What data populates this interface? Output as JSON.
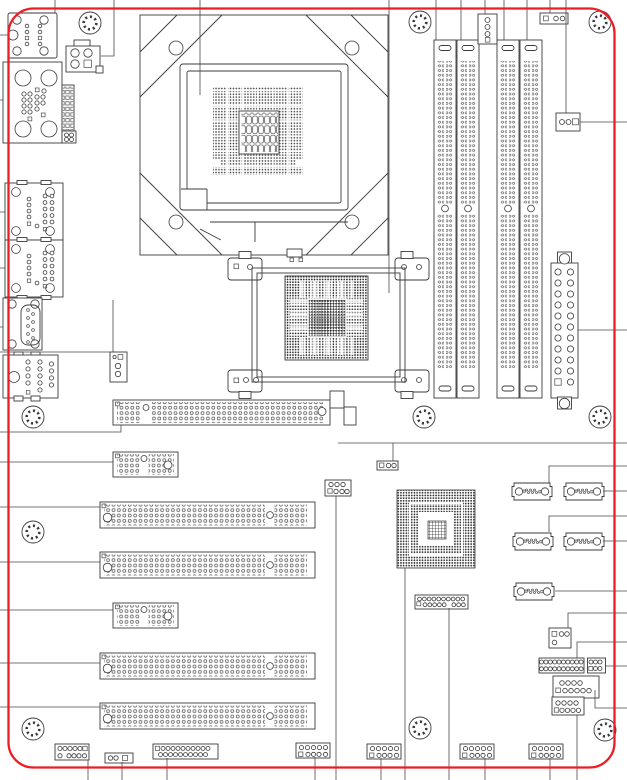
{
  "page": {
    "title": "Motherboard layout diagram",
    "background": "#ffffff"
  },
  "colors": {
    "board_outline": "#ee1c25",
    "line": "#3b3b3b",
    "pin": "#555555"
  },
  "board": {
    "counts": {
      "cpu_sockets": 1,
      "dimm_slots": 4,
      "pci_slots": 4,
      "short_expansion_slots": 2,
      "long_expansion_slots": 1,
      "sata_ports": 5,
      "bga_chips": 2,
      "mounting_holes": 10,
      "bottom_edge_headers": 7,
      "rear_io_connectors": 6
    },
    "regions": [
      "rear-io",
      "cpu-socket",
      "northbridge",
      "dimm-bank",
      "atx-power",
      "expansion-slots",
      "super-io",
      "sata-bank",
      "front-panel-headers"
    ]
  }
}
